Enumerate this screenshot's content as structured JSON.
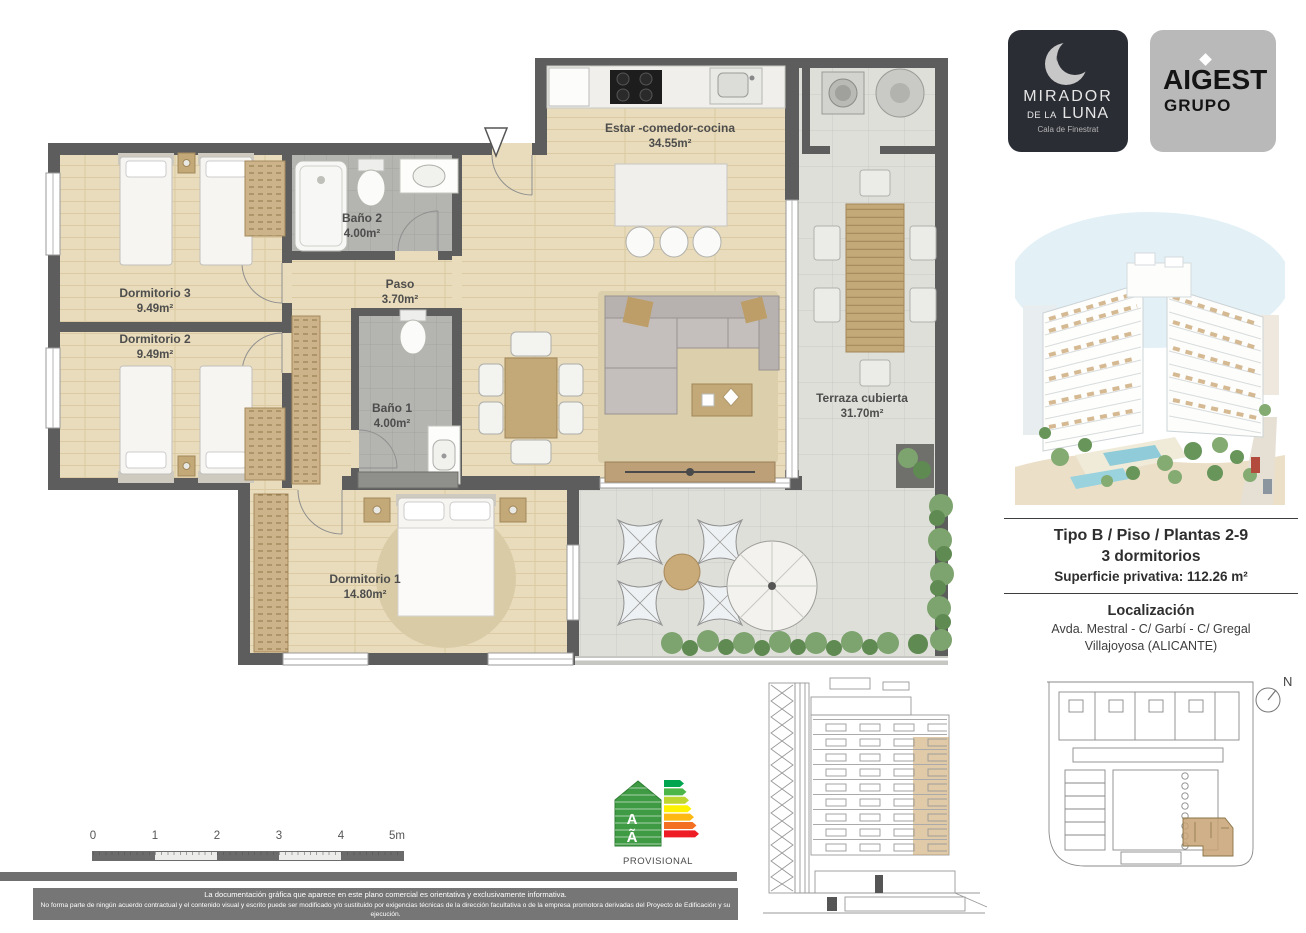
{
  "logos": {
    "mirador": {
      "line1": "MIRADOR",
      "line2a": "DE LA",
      "line2b": "LUNA",
      "subtitle": "Cala de Finestrat"
    },
    "aigest": {
      "line1": "AIGEST",
      "line2": "GRUPO"
    }
  },
  "floorplan": {
    "rooms": {
      "estar": {
        "name": "Estar -comedor-cocina",
        "area": "34.55m²"
      },
      "dorm3": {
        "name": "Dormitorio 3",
        "area": "9.49m²"
      },
      "dorm2": {
        "name": "Dormitorio 2",
        "area": "9.49m²"
      },
      "bano2": {
        "name": "Baño 2",
        "area": "4.00m²"
      },
      "paso": {
        "name": "Paso",
        "area": "3.70m²"
      },
      "bano1": {
        "name": "Baño 1",
        "area": "4.00m²"
      },
      "dorm1": {
        "name": "Dormitorio 1",
        "area": "14.80m²"
      },
      "terraza": {
        "name": "Terraza cubierta",
        "area": "31.70m²"
      }
    }
  },
  "info": {
    "type_line": "Tipo B / Piso / Plantas 2-9",
    "bedrooms_line": "3 dormitorios",
    "surface_line": "Superficie privativa: 112.26 m²",
    "location_title": "Localización",
    "location_line1": "Avda. Mestral - C/ Garbí - C/ Gregal",
    "location_line2": "Villajoyosa (ALICANTE)"
  },
  "scalebar": {
    "labels": [
      "0",
      "1",
      "2",
      "3",
      "4",
      "5m"
    ]
  },
  "energy": {
    "letter_top": "A",
    "letter_bottom": "Ã",
    "caption": "PROVISIONAL",
    "arrow_colors": [
      "#00a550",
      "#4cb648",
      "#bed62f",
      "#fef200",
      "#fdb813",
      "#f36f21",
      "#ee1c25"
    ]
  },
  "compass": {
    "n": "N"
  },
  "disclaimer": {
    "line1": "La documentación gráfica que aparece en este plano comercial es orientativa y exclusivamente informativa.",
    "line2": "No forma parte de ningún acuerdo contractual y el contenido visual y escrito puede ser modificado y/o sustituido por exigencias técnicas de la dirección facultativa o de la empresa promotora derivadas del Proyecto de Edificación y su ejecución."
  },
  "colors": {
    "wall": "#5d5d5d",
    "wood": "#e9dcbc",
    "tile": "#dfdfda",
    "bath": "#b4b4b0",
    "highlight_tan": "#c7a273",
    "logo_dark": "#2b2d35",
    "logo_gray": "#b9b9b9"
  }
}
